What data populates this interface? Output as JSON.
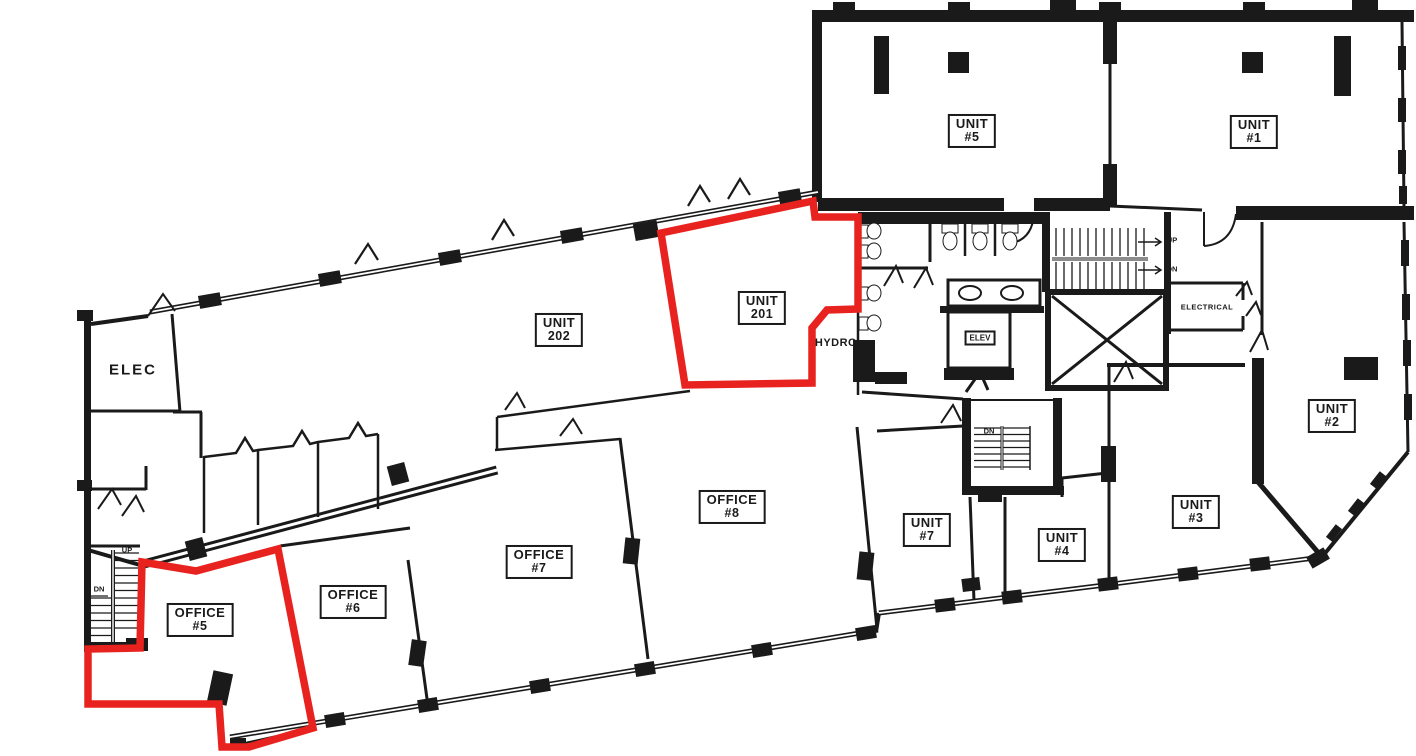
{
  "document": {
    "type": "floor-plan",
    "background": "#ffffff",
    "ink": "#1a1a1a"
  },
  "highlight": {
    "color": "#e8231f",
    "units": [
      "UNIT 201",
      "OFFICE #5"
    ]
  },
  "rooms": {
    "unit5": {
      "line1": "UNIT",
      "line2": "#5"
    },
    "unit1": {
      "line1": "UNIT",
      "line2": "#1"
    },
    "unit202": {
      "line1": "UNIT",
      "line2": "202"
    },
    "unit201": {
      "line1": "UNIT",
      "line2": "201"
    },
    "unit2": {
      "line1": "UNIT",
      "line2": "#2"
    },
    "unit3": {
      "line1": "UNIT",
      "line2": "#3"
    },
    "unit4": {
      "line1": "UNIT",
      "line2": "#4"
    },
    "unit7": {
      "line1": "UNIT",
      "line2": "#7"
    },
    "office8": {
      "line1": "OFFICE",
      "line2": "#8"
    },
    "office7": {
      "line1": "OFFICE",
      "line2": "#7"
    },
    "office6": {
      "line1": "OFFICE",
      "line2": "#6"
    },
    "office5": {
      "line1": "OFFICE",
      "line2": "#5"
    }
  },
  "service": {
    "elec": "ELEC",
    "hydro": "HYDRO",
    "elev": "ELEV",
    "electrical": "ELECTRICAL"
  },
  "stairs": {
    "up_main": "UP",
    "dn_main": "DN",
    "dn_mid": "DN",
    "up_sw": "UP",
    "dn_sw": "DN"
  }
}
